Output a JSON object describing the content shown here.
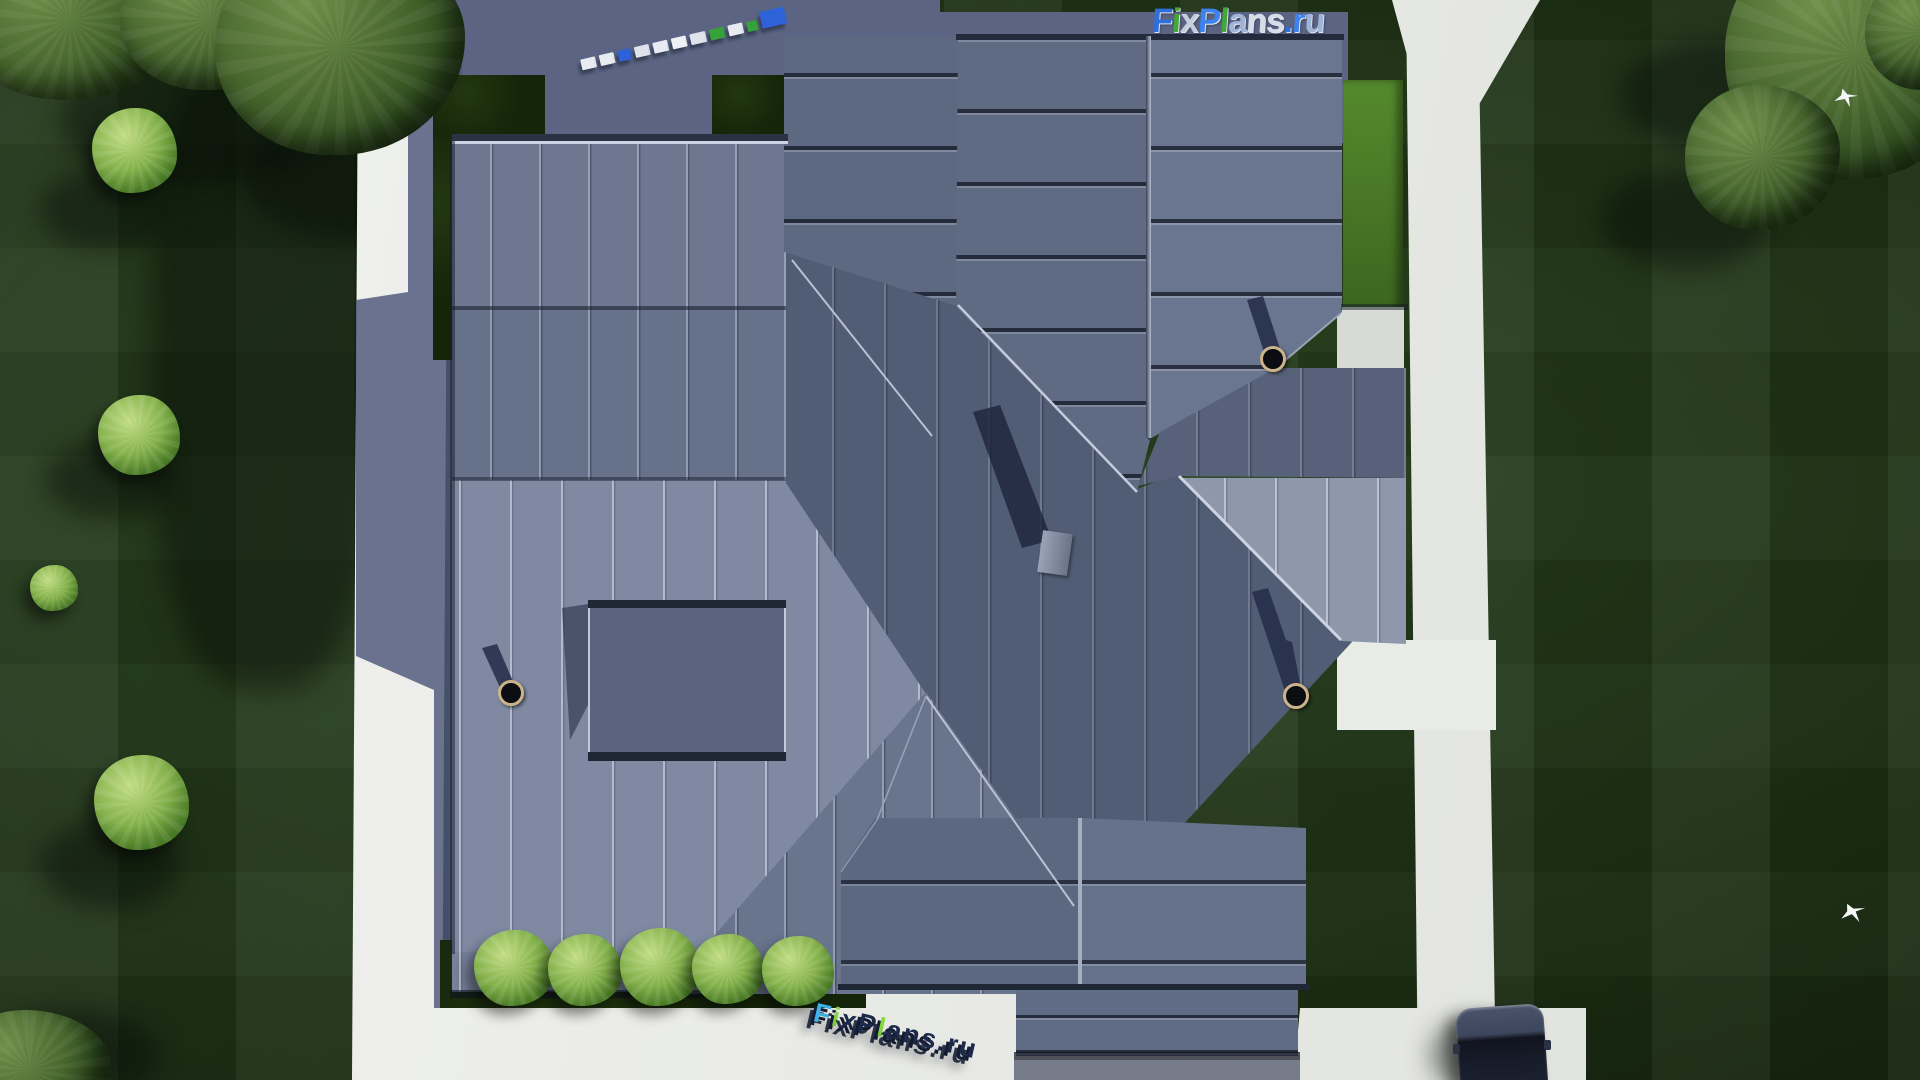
{
  "brand": {
    "name": "FixPlans.ru",
    "top_letters": [
      {
        "ch": "F",
        "color": "#2f6fdd"
      },
      {
        "ch": "i",
        "color": "#41a83a"
      },
      {
        "ch": "x",
        "color": "#c5cede"
      },
      {
        "ch": "P",
        "color": "#3c82f0"
      },
      {
        "ch": "l",
        "color": "#41a83a"
      },
      {
        "ch": "a",
        "color": "#9fb4d8"
      },
      {
        "ch": "n",
        "color": "#d6dce8"
      },
      {
        "ch": "s",
        "color": "#d6dce8"
      },
      {
        "ch": ".",
        "color": "#2f6fdd"
      },
      {
        "ch": "r",
        "color": "#3c82f0"
      },
      {
        "ch": "u",
        "color": "#9fb4d8"
      }
    ],
    "bottom_letters": [
      {
        "ch": "F",
        "color": "#3fb3e8"
      },
      {
        "ch": "i",
        "color": "#86d93f"
      },
      {
        "ch": "x",
        "color": "#1e2a4c"
      },
      {
        "ch": "P",
        "color": "#1e2a4c"
      },
      {
        "ch": "l",
        "color": "#86d93f"
      },
      {
        "ch": "a",
        "color": "#1e2a4c"
      },
      {
        "ch": "n",
        "color": "#1e2a4c"
      },
      {
        "ch": "s",
        "color": "#1e2a4c"
      },
      {
        "ch": ".",
        "color": "#1e2a4c"
      },
      {
        "ch": "r",
        "color": "#1e2a4c"
      },
      {
        "ch": "u",
        "color": "#1e2a4c"
      }
    ],
    "mini_blocks": [
      "#e8ecf2",
      "#e8ecf2",
      "#2e62d8",
      "#dfe4ec",
      "#e8ecf2",
      "#eef1f5",
      "#dfe4ec",
      "#37a23a",
      "#e8ecf2",
      "#37a23a",
      "#2e62d8"
    ]
  },
  "scene": {
    "view": "top-down aerial render of a house with standing-seam metal roof",
    "counts": {
      "chimneys": 3,
      "roof_vent": 1,
      "skylight_panels": 4,
      "front_bushes": 5,
      "birds": 2,
      "cars": 1
    },
    "palette": {
      "roof_dark": "#515d75",
      "roof_medium": "#66718a",
      "roof_light": "#7f8aa2",
      "roof_sunlit": "#8e98ad",
      "lawn": "#243c1b",
      "lawn_dark": "#1b2e12",
      "hedge_dark": "#152509",
      "hedge_lit": "#4c7d27",
      "path": "#eceee9",
      "ground_shadow": "#5b6583",
      "car_body": "#3c465c",
      "chimney_ring": "#cdb38a"
    }
  }
}
